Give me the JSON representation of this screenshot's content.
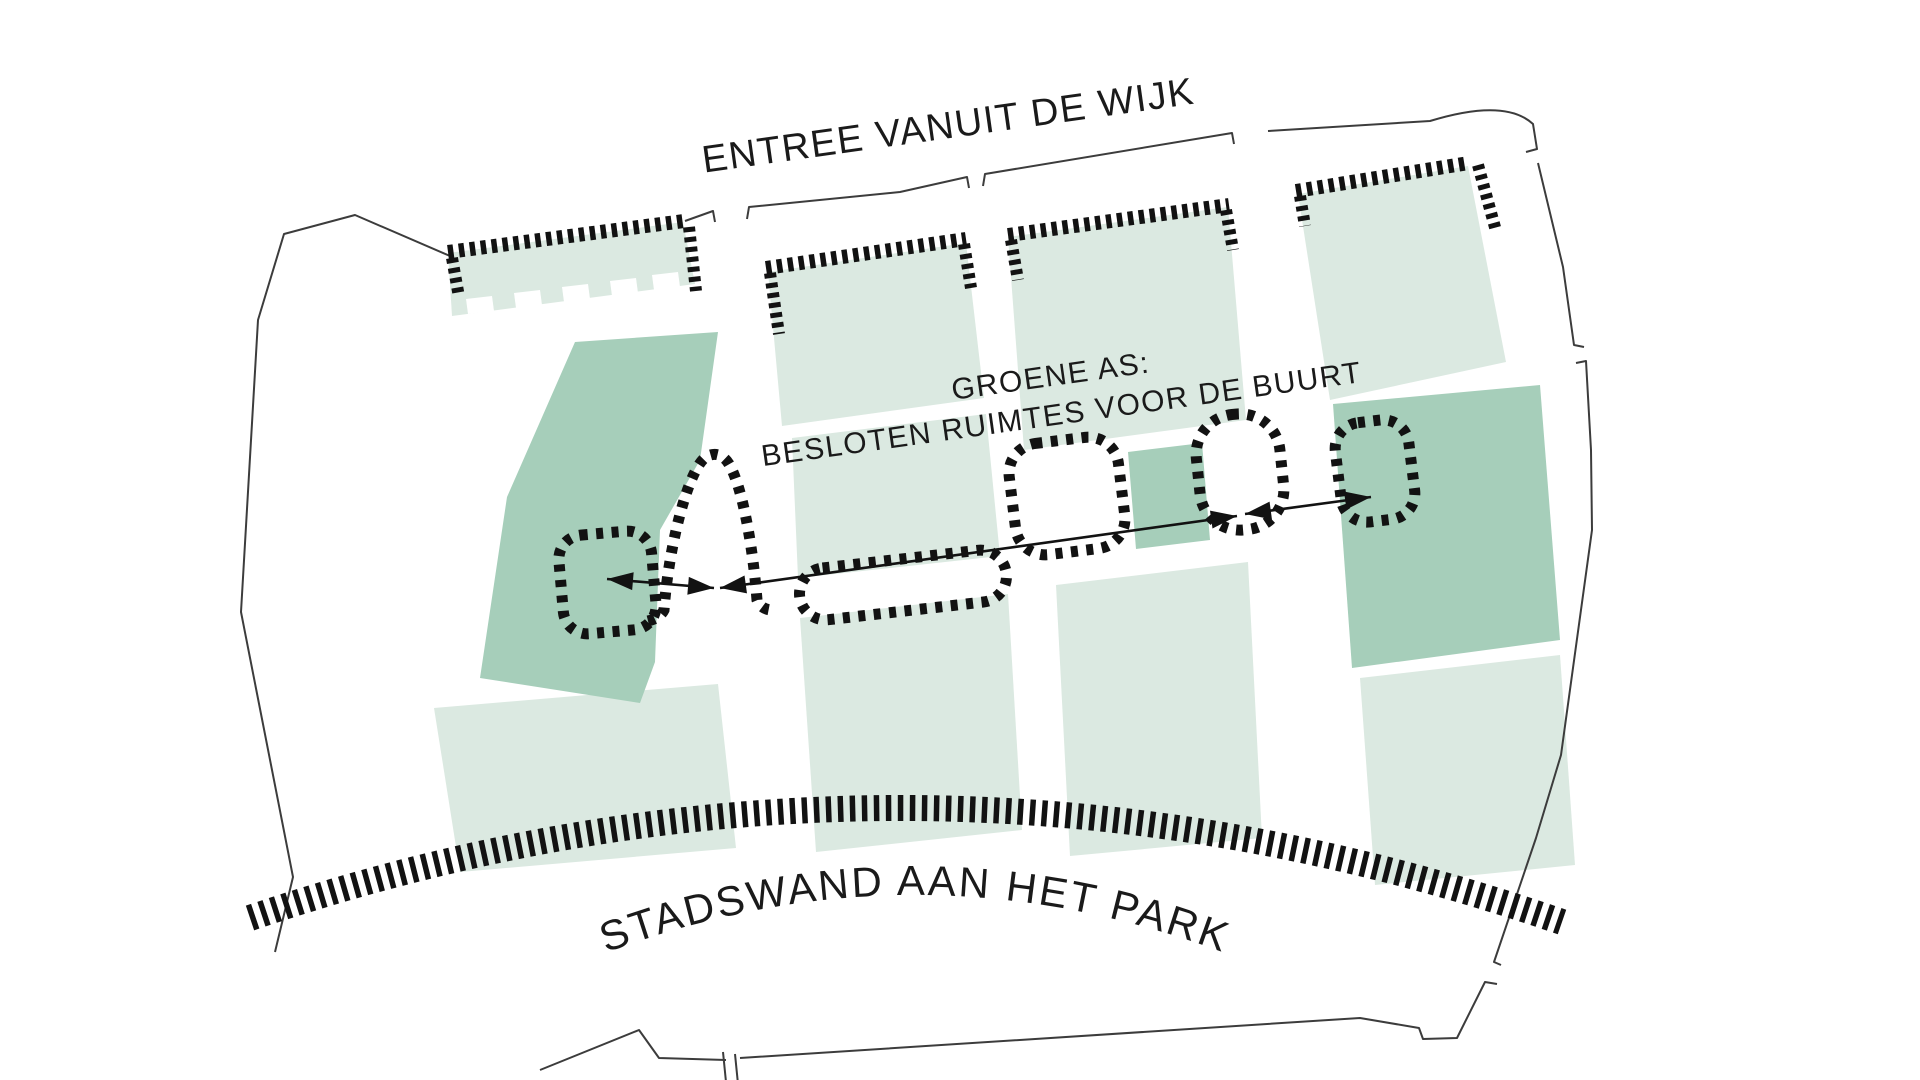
{
  "labels": {
    "top": "ENTREE VANUIT DE WIJK",
    "axis1": "GROENE AS:",
    "axis2": "BESLOTEN RUIMTES VOOR DE BUURT",
    "bottom": "STADSWAND AAN HET PARK"
  },
  "colors": {
    "background": "#ffffff",
    "block_light": "#dbe9e1",
    "block_dark": "#a6ceba",
    "ink": "#121212",
    "boundary": "#3c3c3c",
    "text": "#1a1a1a"
  },
  "canvas": {
    "w": 1920,
    "h": 1080
  },
  "blocks_light": [
    {
      "name": "block-top-1",
      "pts": "448,253 683,222 695,284 452,316"
    },
    {
      "name": "block-top-2",
      "pts": "768,272 966,243 984,398 782,426"
    },
    {
      "name": "block-top-3",
      "pts": "1008,237 1228,207 1246,420 1024,450"
    },
    {
      "name": "block-top-4",
      "pts": "1298,194 1468,166 1506,362 1330,400"
    },
    {
      "name": "block-mid-1",
      "pts": "792,438 986,414 1000,556 798,578"
    },
    {
      "name": "block-bottom-mid",
      "pts": "800,618 1008,594 1022,830 816,852"
    },
    {
      "name": "block-bottom-left",
      "pts": "434,708 718,684 736,848 460,872"
    },
    {
      "name": "block-bottom-3",
      "pts": "1056,585 1248,562 1262,838 1070,856"
    },
    {
      "name": "block-bottom-right",
      "pts": "1360,678 1560,655 1575,865 1375,885"
    }
  ],
  "block_cutouts_white": [
    {
      "name": "block-top-1-notch",
      "pts": "466,299 492,296 494,311 468,314"
    },
    {
      "name": "block-top-1-notch",
      "pts": "514,293 540,290 542,305 516,308"
    },
    {
      "name": "block-top-1-notch",
      "pts": "562,287 588,284 590,299 564,302"
    },
    {
      "name": "block-top-1-notch",
      "pts": "610,281 636,278 638,293 612,296"
    },
    {
      "name": "block-top-1-notch",
      "pts": "652,275 678,272 680,287 654,290"
    }
  ],
  "blocks_dark": [
    {
      "name": "green-block-left",
      "pts": "575,342 718,332 700,460 660,530 655,662 640,703 480,678 507,497"
    },
    {
      "name": "green-block-small",
      "pts": "1128,452 1202,443 1210,540 1136,549"
    },
    {
      "name": "green-block-right",
      "pts": "1333,404 1540,385 1560,640 1352,668"
    }
  ],
  "dashed_bars": [
    {
      "name": "entry-wall-1",
      "x1": 448,
      "y1": 252,
      "x2": 684,
      "y2": 221,
      "w": 14,
      "dash": "5.5 5.5"
    },
    {
      "name": "entry-wall-2",
      "x1": 766,
      "y1": 268,
      "x2": 966,
      "y2": 239,
      "w": 14,
      "dash": "5.5 5.5"
    },
    {
      "name": "entry-wall-3",
      "x1": 1008,
      "y1": 235,
      "x2": 1229,
      "y2": 205,
      "w": 14,
      "dash": "5.5 5.5"
    },
    {
      "name": "entry-wall-4",
      "x1": 1296,
      "y1": 191,
      "x2": 1469,
      "y2": 163,
      "w": 14,
      "dash": "5.5 5.5"
    },
    {
      "name": "entry-wall-1-left-col",
      "x1": 452,
      "y1": 258,
      "x2": 459,
      "y2": 297,
      "w": 12,
      "dash": "5 5"
    },
    {
      "name": "entry-wall-1-right-col",
      "x1": 689,
      "y1": 227,
      "x2": 696,
      "y2": 291,
      "w": 12,
      "dash": "5 5"
    },
    {
      "name": "entry-wall-2-left-col",
      "x1": 770,
      "y1": 273,
      "x2": 779,
      "y2": 334,
      "w": 12,
      "dash": "5 5"
    },
    {
      "name": "entry-wall-2-right-col",
      "x1": 964,
      "y1": 244,
      "x2": 971,
      "y2": 288,
      "w": 12,
      "dash": "5 5"
    },
    {
      "name": "entry-wall-3-left-col",
      "x1": 1011,
      "y1": 240,
      "x2": 1018,
      "y2": 280,
      "w": 12,
      "dash": "5 5"
    },
    {
      "name": "entry-wall-3-right-col",
      "x1": 1226,
      "y1": 210,
      "x2": 1233,
      "y2": 250,
      "w": 12,
      "dash": "5 5"
    },
    {
      "name": "entry-wall-4-left-col",
      "x1": 1300,
      "y1": 196,
      "x2": 1305,
      "y2": 226,
      "w": 12,
      "dash": "5 5"
    },
    {
      "name": "entry-wall-4-right-col",
      "x1": 1478,
      "y1": 165,
      "x2": 1496,
      "y2": 231,
      "w": 12,
      "dash": "5 5"
    }
  ],
  "park_band": {
    "name": "park-edge-band",
    "d": "M 250 918 Q 906 696 1562 922",
    "width": 26,
    "dash": "5.5 6.5"
  },
  "dotted_rooms": [
    {
      "name": "enclosed-room-1",
      "kind": "rect",
      "x": 561,
      "y": 533,
      "w": 93,
      "h": 99,
      "rx": 24,
      "rot": -5,
      "cx": 607,
      "cy": 583
    },
    {
      "name": "enclosed-room-2-arch",
      "kind": "path",
      "d": "M 648 621 C 656 619 661 616 664 610 C 669 543 689 468 706 457 C 714 452 723 454 729 464 C 743 488 753 549 757 600 C 760 607 766 610 772 610"
    },
    {
      "name": "enclosed-room-3",
      "kind": "rect",
      "x": 799,
      "y": 559,
      "w": 208,
      "h": 52,
      "rx": 26,
      "rot": -6.5,
      "cx": 903,
      "cy": 585
    },
    {
      "name": "enclosed-room-4",
      "kind": "rect",
      "x": 1012,
      "y": 440,
      "w": 110,
      "h": 112,
      "rx": 30,
      "rot": -7,
      "cx": 1067,
      "cy": 496
    },
    {
      "name": "enclosed-room-5",
      "kind": "rect",
      "x": 1198,
      "y": 414,
      "w": 84,
      "h": 116,
      "rx": 40,
      "rot": -6,
      "cx": 1240,
      "cy": 472
    },
    {
      "name": "enclosed-room-6",
      "kind": "rect",
      "x": 1338,
      "y": 421,
      "w": 74,
      "h": 100,
      "rx": 26,
      "rot": -7,
      "cx": 1375,
      "cy": 471
    }
  ],
  "room_stroke": {
    "width": 11,
    "dash": "7 8.5"
  },
  "axis_arrows": [
    {
      "name": "axis-arrow-1",
      "x1": 607,
      "y1": 579,
      "x2": 714,
      "y2": 588
    },
    {
      "name": "axis-arrow-2",
      "x1": 720,
      "y1": 588,
      "x2": 1237,
      "y2": 516
    },
    {
      "name": "axis-arrow-3",
      "x1": 1245,
      "y1": 514,
      "x2": 1371,
      "y2": 497
    }
  ],
  "boundary_paths": [
    {
      "name": "boundary-left",
      "d": "M 275 952 L 293 877 L 241 612 L 258 320 L 284 234 L 355 215 L 450 256"
    },
    {
      "name": "boundary-top-1",
      "d": "M 685 221 L 713 211 L 715 222"
    },
    {
      "name": "boundary-top-2",
      "d": "M 747 219 L 749 207 L 900 192 L 967 177 L 969 188"
    },
    {
      "name": "boundary-top-3",
      "d": "M 983 186 L 985 174 L 1232 133 L 1234 144"
    },
    {
      "name": "boundary-top-right",
      "d": "M 1268 131 L 1430 121 Q 1505 98 1533 124 L 1537 149 L 1526 152"
    },
    {
      "name": "boundary-right-1",
      "d": "M 1538 163 L 1563 267 L 1574 345 L 1584 347"
    },
    {
      "name": "boundary-right-2",
      "d": "M 1576 363 L 1586 361 L 1591 450 L 1592 530 L 1561 755 L 1536 838 L 1494 962 L 1501 965"
    },
    {
      "name": "boundary-bottom-right",
      "d": "M 1497 984 L 1485 982 L 1457 1038 L 1423 1039 L 1419 1028 L 1360 1018 L 740 1058"
    },
    {
      "name": "boundary-bottom-left",
      "d": "M 726 1060 L 659 1058 L 639 1030 L 540 1070"
    },
    {
      "name": "boundary-tick-1",
      "d": "M 723 1052 L 726 1082"
    },
    {
      "name": "boundary-tick-2",
      "d": "M 735 1054 L 738 1084"
    }
  ],
  "texts": [
    {
      "name": "entree-label",
      "bind": "labels.top",
      "x": 950,
      "y": 138,
      "rot": -8,
      "size": 38,
      "ls": 1.5
    },
    {
      "name": "groene-as-label-line1",
      "bind": "labels.axis1",
      "x": 1052,
      "y": 386,
      "rot": -8,
      "size": 30,
      "ls": 1.5
    },
    {
      "name": "groene-as-label-line2",
      "bind": "labels.axis2",
      "x": 1063,
      "y": 424,
      "rot": -8,
      "size": 30,
      "ls": 1.5
    },
    {
      "name": "stadswand-label",
      "bind": "labels.bottom",
      "arc": "M 600 955 Q 915 835 1230 955",
      "size": 42,
      "ls": 2.5
    }
  ]
}
